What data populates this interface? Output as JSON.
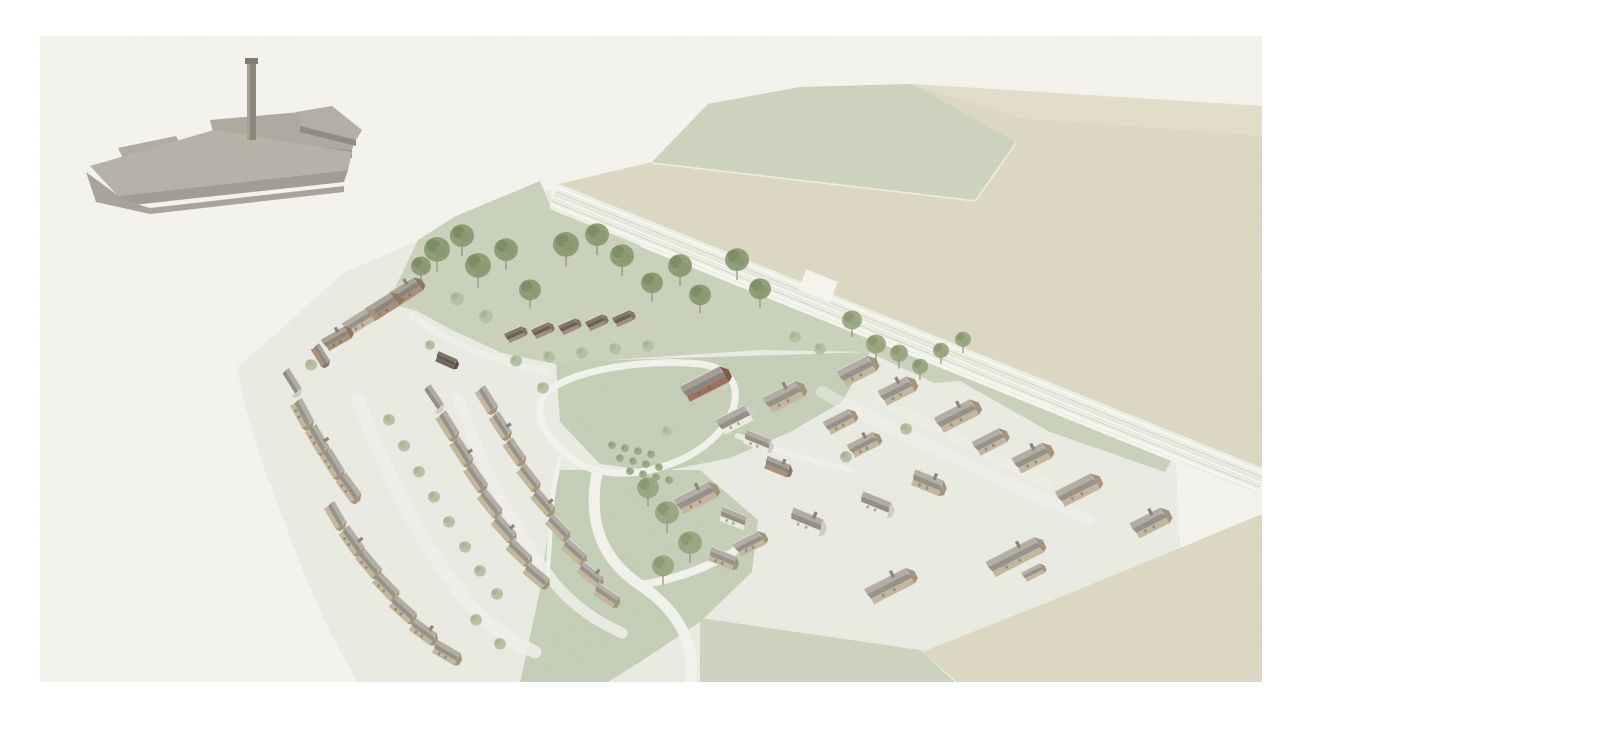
{
  "scene": {
    "description": "Watercolour-style aerial axonometric masterplan illustration of a proposed village housing development: a grey mill building with a tall chimney stands alone at the top left; curved crescents of stone cottages, a central village green with an orchard and looping footpaths, scattered trees, a gabled terrace row, a red brick building, and a railway corridor with parallel tracks separating the site from pale beige and sage farmland fields. No text or UI elements are visible.",
    "palette": {
      "page": "#ffffff",
      "paper": "#f5f4ef",
      "plot": "#ebece4",
      "park_green": "#cbd2bc",
      "central_green": "#c6cfb8",
      "sage_field": "#ced4bf",
      "beige_field": "#ded9c3",
      "beige_field_light": "#e4dfca",
      "rail_band": "#eff1e8",
      "path_white": "#f3f3ed",
      "factory_grey": "#b0aca1",
      "factory_shadow": "#8f8b80",
      "window_dark": "#5d5749"
    },
    "house_palette": {
      "s": {
        "w": "#c4b79d",
        "ws": "#a3957c",
        "rl": "#b2aea5",
        "rd": "#96928a"
      },
      "w": {
        "w": "#edebe2",
        "ws": "#d0cec4",
        "rl": "#b0aca3",
        "rd": "#938f86"
      },
      "b": {
        "w": "#ab9078",
        "ws": "#8c7562",
        "rl": "#a7a29a",
        "rd": "#8a867c"
      },
      "r": {
        "w": "#9d6f5a",
        "ws": "#7f5848",
        "rl": "#a39e95",
        "rd": "#8a857c"
      },
      "t": {
        "w": "#a28c79",
        "ws": "#86705f",
        "rl": "#80766a",
        "rd": "#685e54"
      },
      "d": {
        "w": "#6f6657",
        "ws": "#594f40",
        "rl": "#7b7263",
        "rd": "#615a4c"
      }
    },
    "tree_palette": {
      "b": {
        "f": "#89996f",
        "d": "#6d7f57"
      },
      "m": {
        "f": "#97a67e",
        "d": "#7d8d64"
      },
      "s": {
        "f": "#b6bfa1",
        "d": "#9dab87"
      },
      "o": {
        "f": "#9baa84",
        "d": "#86966f"
      }
    },
    "houses": [
      [
        404,
        291,
        -32,
        30,
        "b",
        1
      ],
      [
        381,
        306,
        -32,
        30,
        "b",
        0
      ],
      [
        357,
        321,
        -32,
        28,
        "s",
        0
      ],
      [
        335,
        338,
        -30,
        26,
        "b",
        1
      ],
      [
        321,
        354,
        58,
        20,
        "b",
        0
      ],
      [
        291,
        381,
        58,
        24,
        "w",
        0
      ],
      [
        446,
        359,
        24,
        20,
        "d",
        0
      ],
      [
        514,
        334,
        -24,
        18,
        "t",
        0
      ],
      [
        541,
        330,
        -24,
        18,
        "t",
        0
      ],
      [
        568,
        326,
        -24,
        18,
        "t",
        0
      ],
      [
        595,
        322,
        -24,
        18,
        "t",
        0
      ],
      [
        622,
        318,
        -24,
        18,
        "t",
        0
      ],
      [
        303,
        412,
        62,
        26,
        "s",
        0
      ],
      [
        318,
        438,
        60,
        26,
        "s",
        1
      ],
      [
        333,
        462,
        58,
        26,
        "s",
        0
      ],
      [
        349,
        486,
        54,
        26,
        "s",
        0
      ],
      [
        336,
        514,
        60,
        24,
        "s",
        0
      ],
      [
        352,
        539,
        54,
        26,
        "s",
        1
      ],
      [
        369,
        562,
        50,
        26,
        "s",
        0
      ],
      [
        386,
        585,
        46,
        26,
        "s",
        0
      ],
      [
        403,
        608,
        42,
        26,
        "s",
        0
      ],
      [
        423,
        630,
        36,
        26,
        "s",
        1
      ],
      [
        446,
        651,
        30,
        26,
        "s",
        0
      ],
      [
        433,
        397,
        56,
        24,
        "w",
        0
      ],
      [
        448,
        424,
        58,
        25,
        "s",
        0
      ],
      [
        462,
        450,
        57,
        25,
        "s",
        1
      ],
      [
        476,
        476,
        55,
        25,
        "s",
        0
      ],
      [
        490,
        502,
        51,
        25,
        "s",
        0
      ],
      [
        504,
        527,
        48,
        25,
        "s",
        1
      ],
      [
        519,
        551,
        44,
        25,
        "s",
        0
      ],
      [
        536,
        574,
        40,
        25,
        "s",
        0
      ],
      [
        487,
        398,
        58,
        24,
        "s",
        0
      ],
      [
        501,
        424,
        57,
        24,
        "s",
        1
      ],
      [
        515,
        450,
        55,
        24,
        "s",
        0
      ],
      [
        529,
        476,
        52,
        24,
        "s",
        0
      ],
      [
        543,
        501,
        49,
        24,
        "s",
        1
      ],
      [
        558,
        526,
        46,
        24,
        "s",
        0
      ],
      [
        574,
        550,
        42,
        24,
        "s",
        0
      ],
      [
        590,
        573,
        38,
        24,
        "s",
        1
      ],
      [
        606,
        594,
        34,
        24,
        "s",
        0
      ],
      [
        703,
        383,
        -27,
        44,
        "r",
        0
      ],
      [
        733,
        419,
        -27,
        32,
        "w",
        0
      ],
      [
        782,
        396,
        -27,
        36,
        "s",
        1
      ],
      [
        757,
        440,
        22,
        26,
        "w",
        0
      ],
      [
        777,
        465,
        22,
        24,
        "b",
        1
      ],
      [
        694,
        497,
        -27,
        38,
        "s",
        1
      ],
      [
        733,
        517,
        22,
        26,
        "w",
        0
      ],
      [
        722,
        557,
        22,
        26,
        "s",
        0
      ],
      [
        748,
        543,
        -27,
        28,
        "s",
        0
      ],
      [
        806,
        520,
        22,
        32,
        "w",
        1
      ],
      [
        855,
        370,
        -27,
        34,
        "s",
        0
      ],
      [
        895,
        390,
        -27,
        32,
        "s",
        1
      ],
      [
        838,
        421,
        -27,
        28,
        "s",
        0
      ],
      [
        862,
        444,
        -27,
        28,
        "s",
        1
      ],
      [
        955,
        415,
        -27,
        40,
        "s",
        1
      ],
      [
        988,
        441,
        -27,
        30,
        "s",
        0
      ],
      [
        1030,
        457,
        -27,
        34,
        "s",
        1
      ],
      [
        1076,
        489,
        -27,
        40,
        "s",
        0
      ],
      [
        927,
        481,
        22,
        30,
        "s",
        1
      ],
      [
        875,
        503,
        22,
        30,
        "w",
        0
      ],
      [
        1148,
        522,
        -27,
        34,
        "s",
        1
      ],
      [
        1013,
        556,
        -27,
        54,
        "s",
        1
      ],
      [
        1032,
        572,
        -27,
        20,
        "s",
        0
      ],
      [
        888,
        585,
        -27,
        46,
        "s",
        1
      ]
    ],
    "trees": [
      [
        437,
        252,
        13,
        "b"
      ],
      [
        462,
        238,
        12,
        "b"
      ],
      [
        478,
        268,
        13,
        "b"
      ],
      [
        506,
        252,
        12,
        "b"
      ],
      [
        530,
        292,
        11,
        "b"
      ],
      [
        566,
        247,
        13,
        "b"
      ],
      [
        597,
        237,
        12,
        "b"
      ],
      [
        622,
        258,
        12,
        "b"
      ],
      [
        652,
        285,
        11,
        "b"
      ],
      [
        680,
        268,
        12,
        "b"
      ],
      [
        700,
        297,
        11,
        "b"
      ],
      [
        737,
        262,
        12,
        "b"
      ],
      [
        760,
        291,
        11,
        "b"
      ],
      [
        421,
        268,
        10,
        "b"
      ],
      [
        852,
        322,
        10,
        "m"
      ],
      [
        876,
        346,
        10,
        "m"
      ],
      [
        899,
        355,
        9,
        "m"
      ],
      [
        920,
        368,
        8,
        "m"
      ],
      [
        941,
        352,
        8,
        "m"
      ],
      [
        963,
        341,
        8,
        "m"
      ],
      [
        648,
        490,
        11,
        "m"
      ],
      [
        667,
        515,
        12,
        "m"
      ],
      [
        690,
        545,
        12,
        "m"
      ],
      [
        663,
        568,
        11,
        "m"
      ],
      [
        516,
        362,
        6,
        "s"
      ],
      [
        549,
        358,
        6,
        "s"
      ],
      [
        582,
        354,
        6,
        "s"
      ],
      [
        615,
        350,
        6,
        "s"
      ],
      [
        648,
        347,
        6,
        "s"
      ],
      [
        389,
        421,
        6,
        "s"
      ],
      [
        404,
        447,
        6,
        "s"
      ],
      [
        419,
        473,
        6,
        "s"
      ],
      [
        434,
        498,
        6,
        "s"
      ],
      [
        449,
        523,
        6,
        "s"
      ],
      [
        465,
        548,
        6,
        "s"
      ],
      [
        480,
        572,
        6,
        "s"
      ],
      [
        497,
        595,
        6,
        "s"
      ],
      [
        457,
        300,
        7,
        "s"
      ],
      [
        486,
        318,
        7,
        "s"
      ],
      [
        476,
        621,
        6,
        "s"
      ],
      [
        500,
        645,
        6,
        "s"
      ],
      [
        311,
        366,
        6,
        "s"
      ],
      [
        430,
        346,
        5,
        "s"
      ],
      [
        846,
        458,
        6,
        "s"
      ],
      [
        906,
        430,
        6,
        "s"
      ],
      [
        543,
        389,
        6,
        "s"
      ],
      [
        667,
        432,
        5,
        "s"
      ],
      [
        820,
        350,
        6,
        "s"
      ],
      [
        795,
        338,
        6,
        "s"
      ],
      [
        612,
        446,
        4,
        "o"
      ],
      [
        625,
        449,
        4,
        "o"
      ],
      [
        638,
        452,
        4,
        "o"
      ],
      [
        651,
        455,
        4,
        "o"
      ],
      [
        620,
        459,
        4,
        "o"
      ],
      [
        633,
        462,
        4,
        "o"
      ],
      [
        646,
        465,
        4,
        "o"
      ],
      [
        659,
        468,
        4,
        "o"
      ],
      [
        630,
        472,
        4,
        "o"
      ],
      [
        643,
        475,
        4,
        "o"
      ],
      [
        656,
        478,
        4,
        "o"
      ],
      [
        669,
        481,
        4,
        "o"
      ]
    ]
  }
}
